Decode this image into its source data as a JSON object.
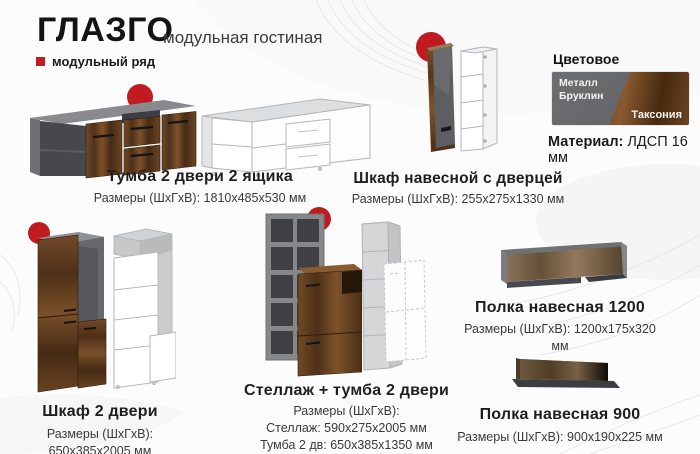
{
  "header": {
    "title": "ГЛАЗГО",
    "subtitle": "модульная гостиная",
    "series_label": "модульный ряд"
  },
  "finish": {
    "heading": "Цветовое исполнение:",
    "swatch_metal": {
      "label": "Металл Бруклин",
      "color": "#6d6f72"
    },
    "swatch_wood": {
      "label": "Таксония",
      "color": "#7a4e26"
    },
    "material_label": "Материал:",
    "material_value": "ЛДСП 16 мм"
  },
  "accent_color": "#bf1b20",
  "products": [
    {
      "title": "Тумба 2 двери 2 ящика",
      "lines": [
        "Размеры (ШхГхВ): 1810х485х530 мм"
      ]
    },
    {
      "title": "Шкаф навесной с дверцей",
      "lines": [
        "Размеры (ШхГхВ): 255х275х1330 мм"
      ]
    },
    {
      "title": "Шкаф 2 двери",
      "lines": [
        "Размеры (ШхГхВ): 650х385х2005 мм"
      ]
    },
    {
      "title": "Стеллаж + тумба 2 двери",
      "lines": [
        "Размеры (ШхГхВ):",
        "Стеллаж: 590х275х2005 мм",
        "Тумба 2 дв: 650х385х1350 мм"
      ]
    },
    {
      "title": "Полка навесная 1200",
      "lines": [
        "Размеры (ШхГхВ): 1200х175х320 мм"
      ]
    },
    {
      "title": "Полка навесная 900",
      "lines": [
        "Размеры (ШхГхВ): 900х190х225 мм"
      ]
    }
  ]
}
